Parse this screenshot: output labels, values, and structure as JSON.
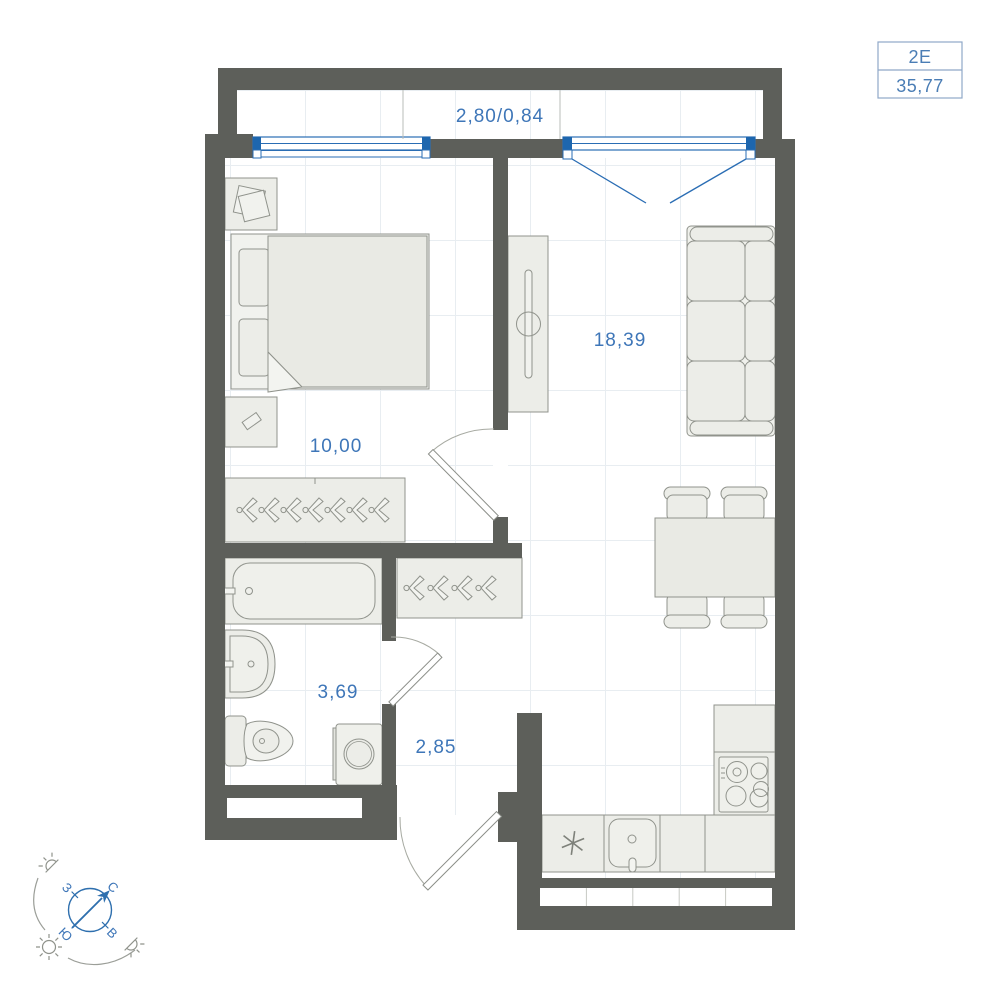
{
  "plan": {
    "unit_type": "2Е",
    "total_area": "35,77",
    "rooms": {
      "balcony": {
        "name": "balcony",
        "label": "2,80/0,84"
      },
      "living": {
        "name": "living-kitchen",
        "label": "18,39"
      },
      "bedroom": {
        "name": "bedroom",
        "label": "10,00"
      },
      "bathroom": {
        "name": "bathroom",
        "label": "3,69"
      },
      "hallway": {
        "name": "hallway",
        "label": "2,85"
      }
    },
    "compass": {
      "north": "С",
      "south": "Ю",
      "west": "З",
      "east": "В"
    },
    "icons": {
      "fridge_mark": "snowflake-asterisk",
      "compass": "compass-rose-with-north-arrow",
      "sun_full": "sun-icon",
      "sun_half": "sunrise-sunset-icon"
    },
    "colors": {
      "wall": "#5d5f5a",
      "window_blue": "#2a6db4",
      "window_cap_blue": "#1d66ae",
      "label_blue": "#3e76b8",
      "furniture_fill": "#ecede8",
      "furniture_stroke": "#90938c",
      "grid": "#e8edf1"
    }
  }
}
